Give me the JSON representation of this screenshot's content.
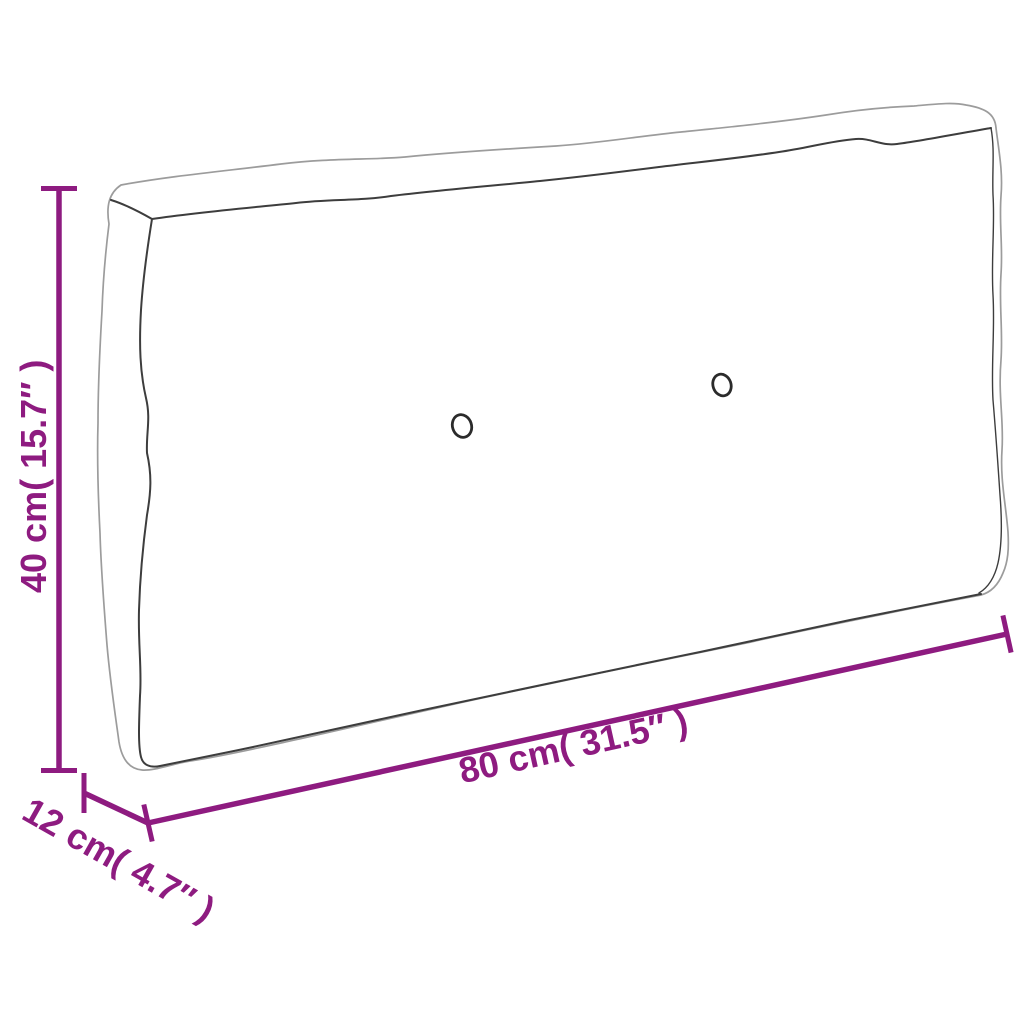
{
  "colors": {
    "accent": "#8E1B80",
    "outline_light": "#9C9C9C",
    "outline_dark": "#3D3D3D",
    "background": "#FFFFFF"
  },
  "diagram": {
    "type": "product-dimension-diagram",
    "subject": "pallet cushion line art with two tufting buttons",
    "dimensions": {
      "height": {
        "value_cm": "40",
        "value_inch": "15.7",
        "label": "40 cm( 15.7″ )"
      },
      "width": {
        "value_cm": "80",
        "value_inch": "31.5",
        "label": "80 cm( 31.5″ )"
      },
      "depth": {
        "value_cm": "12",
        "value_inch": "4.7",
        "label": "12 cm( 4.7″ )"
      }
    }
  }
}
